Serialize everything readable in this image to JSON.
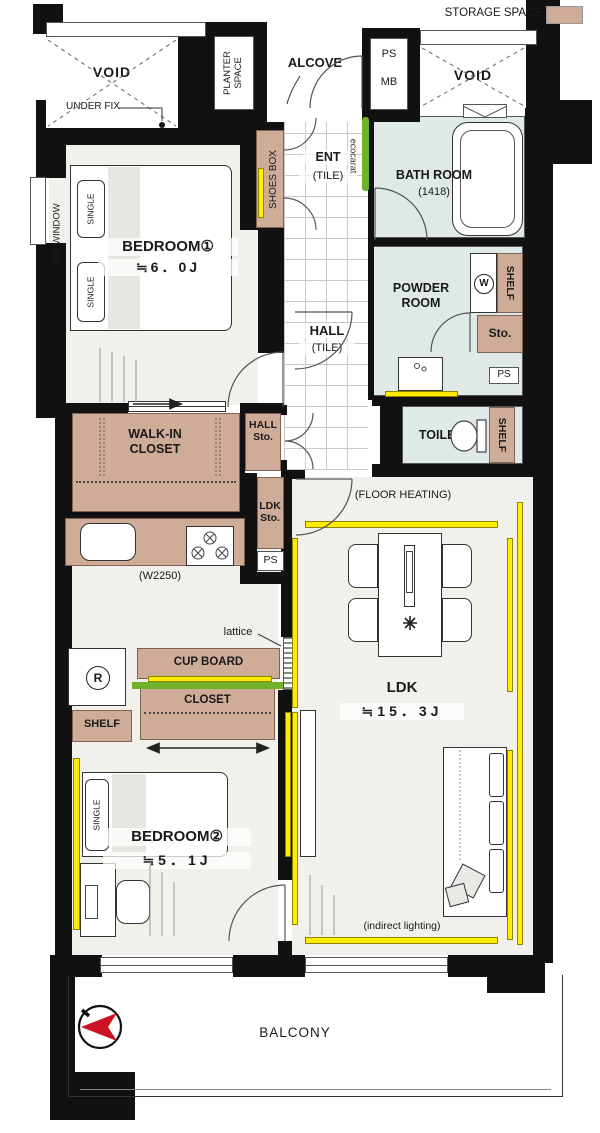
{
  "legend": {
    "storage_space": "STORAGE SPACE"
  },
  "labels": {
    "void": "VOID",
    "under_fix": "UNDER FIX",
    "planter_line1": "PLANTER",
    "planter_line2": "SPACE",
    "alcove": "ALCOVE",
    "ps": "PS",
    "mb": "MB",
    "bay_window": "BAY WINDOW",
    "single": "SINGLE",
    "shoes_box": "SHOES BOX",
    "ent": "ENT",
    "tile": "(TILE)",
    "ecocarat": "ecocarat",
    "shelf": "SHELF",
    "sto": "Sto.",
    "w_mark": "W",
    "r_mark": "R",
    "hall": "HALL",
    "toilet": "TOILET",
    "lattice": "lattice",
    "cup_board": "CUP BOARD",
    "closet": "CLOSET",
    "floor_heating": "(FLOOR HEATING)",
    "indirect_lighting": "(indirect lighting)",
    "balcony": "BALCONY",
    "kitchen_width": "(W2250)"
  },
  "rooms": {
    "bedroom1": {
      "name": "BEDROOM①",
      "size": "≒6．0J"
    },
    "bedroom2": {
      "name": "BEDROOM②",
      "size": "≒5．1J"
    },
    "ldk": {
      "name": "LDK",
      "size": "≒15．3J"
    },
    "bathroom": {
      "name": "BATH ROOM",
      "size": "(1418)"
    },
    "powder_room": {
      "line1": "POWDER",
      "line2": "ROOM"
    },
    "wic": {
      "line1": "WALK-IN",
      "line2": "CLOSET"
    },
    "hall_sto": {
      "line1": "HALL",
      "line2": "Sto."
    },
    "ldk_sto": {
      "line1": "LDK",
      "line2": "Sto."
    }
  },
  "colors": {
    "wall": "#111111",
    "storage_tan": "#cfac97",
    "wet_area_blue": "#dfe9e7",
    "floor_cream": "#f2f0ea",
    "accent_yellow": "#ffec00",
    "ecocarat_green": "#6fb229",
    "compass_red": "#cf1126"
  }
}
